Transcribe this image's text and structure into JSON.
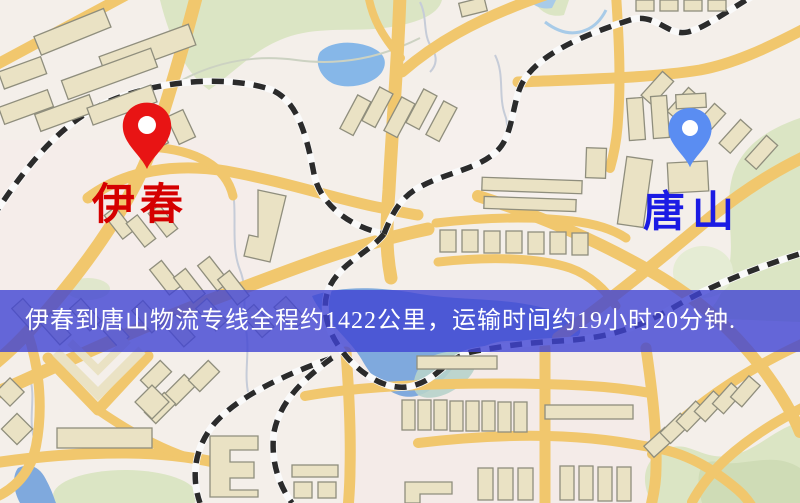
{
  "map": {
    "markers": [
      {
        "label": "伊春",
        "type": "origin",
        "pin_color": "#e81414",
        "label_color": "#d50000"
      },
      {
        "label": "唐山",
        "type": "destination",
        "pin_color": "#5a8df2",
        "label_color": "#1b1be4"
      }
    ],
    "banner": {
      "text": "伊春到唐山物流专线全程约1422公里，运输时间约19小时20分钟.",
      "background_color": "rgba(64,68,211,0.8)",
      "text_color": "#ffffff"
    },
    "colors": {
      "land": "#f4efea",
      "road": "#f1c76d",
      "park": "#dbe5c4",
      "park_light": "#e5ecd4",
      "building_fill": "#eae2c4",
      "building_stroke": "#8f8e7d",
      "water": "#7fa9dd",
      "pond": "#86b7e8",
      "water_shallow": "#b7d3cb",
      "railway": "#2b2b2b",
      "railway_base": "#fafafa",
      "stream": "#c6ccd8",
      "banner_overlay": "rgba(64,68,211,0.8)",
      "banner_text": "#ffffff",
      "pin_origin": "#e81414",
      "pin_dest": "#5a8df2",
      "label_origin": "#d50000",
      "label_dest": "#1b1be4"
    }
  }
}
